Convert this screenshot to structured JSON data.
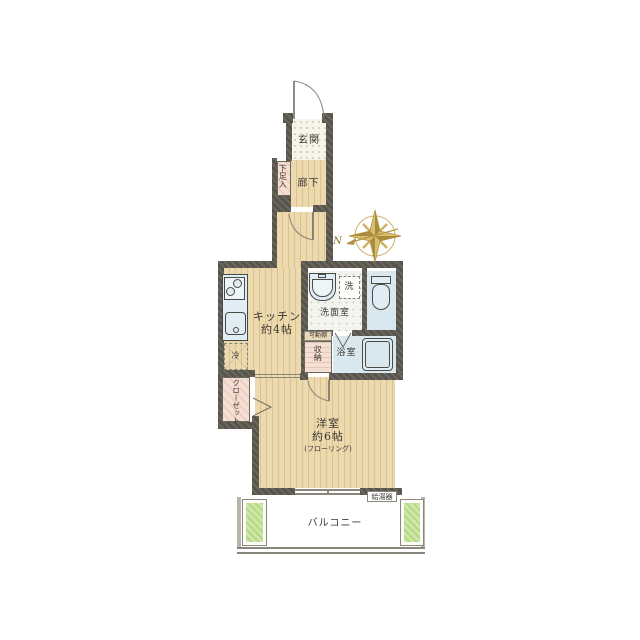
{
  "title": "apartment-floor-plan",
  "labels": {
    "entrance": "玄関",
    "shoe_box": "下足入",
    "corridor": "廊下",
    "kitchen_line1": "キッチン",
    "kitchen_line2": "約4帖",
    "refrigerator": "冷",
    "closet": "クローゼット",
    "washer": "洗",
    "washroom": "洗面室",
    "movable_shelf": "可動棚",
    "storage": "収納",
    "bathroom": "浴室",
    "bedroom_line1": "洋室",
    "bedroom_line2": "約6帖",
    "bedroom_line3": "(フローリング)",
    "balcony": "バルコニー",
    "water_heater": "給湯器",
    "compass_north": "N"
  },
  "rooms": [
    {
      "name": "玄関",
      "type": "entrance"
    },
    {
      "name": "廊下",
      "type": "corridor"
    },
    {
      "name": "キッチン",
      "size": "約4帖",
      "type": "kitchen"
    },
    {
      "name": "洗面室",
      "type": "washroom"
    },
    {
      "name": "浴室",
      "type": "bathroom"
    },
    {
      "name": "洋室",
      "size": "約6帖",
      "finish": "フローリング",
      "type": "bedroom"
    },
    {
      "name": "バルコニー",
      "type": "balcony"
    }
  ],
  "features": [
    "下足入",
    "クローゼット",
    "収納",
    "可動棚",
    "冷",
    "洗",
    "給湯器"
  ],
  "compass": {
    "north_points": "left",
    "label": "N"
  },
  "colors": {
    "wall": "#57544c",
    "wood_floor": "#ecd9ae",
    "wood_stripe": "#dcc28f",
    "fixture_blue": "#e0edf4",
    "tile_blue": "#d9e7ef",
    "closet_pink": "#f5ded3",
    "planter_green": "#cde7a6",
    "compass_gold": "#cfb365",
    "text": "#3b3833"
  }
}
